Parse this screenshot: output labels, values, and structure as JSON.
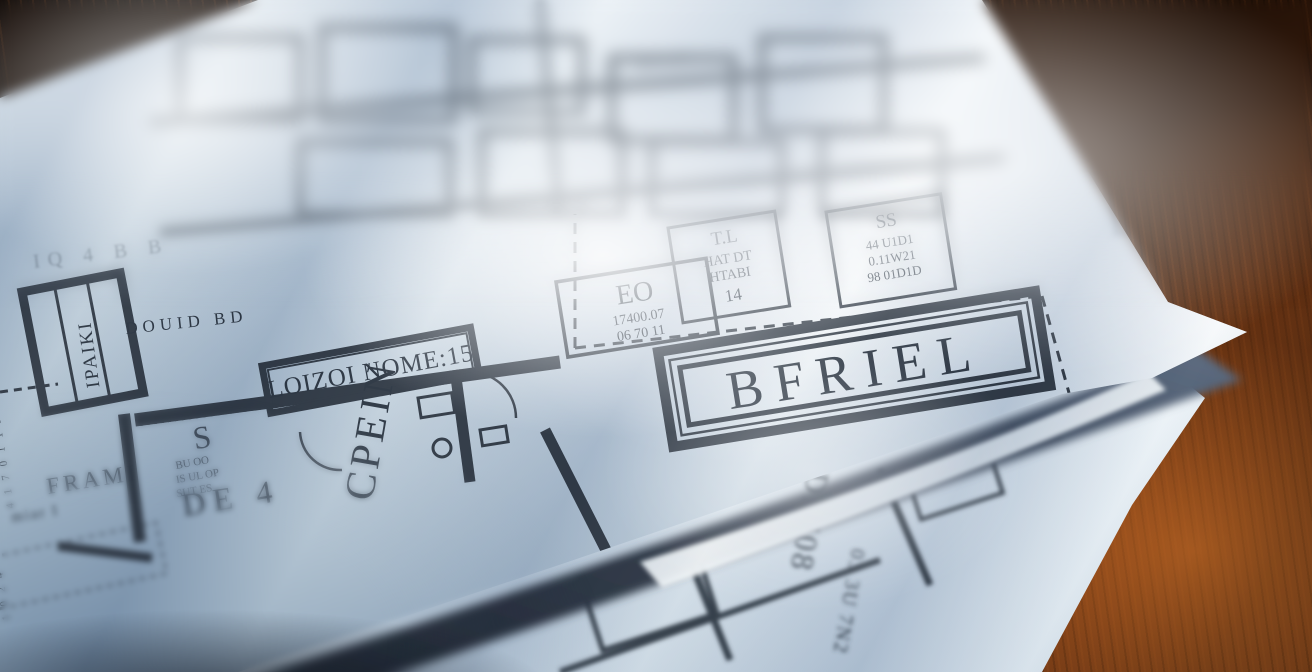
{
  "scene": {
    "subject": "Two architectural floor plan blueprint sheets lying on a dark oak table in diagonal window light",
    "colors": {
      "paper_highlight": "#f8fbfd",
      "paper_shadow": "#93a9bd",
      "ink": "#39424d",
      "wood_dark": "#170b04",
      "wood_grain": "#c46824",
      "under_shadow": "#2f3845"
    }
  },
  "top_sheet": {
    "banner": "LOIZOI NOME:15",
    "room_vertical": "CPEIN",
    "closet_vertical": "IPAIKI",
    "title_block": "BFRIEL",
    "boxes": {
      "eo": {
        "title": "EO",
        "line1": "17400.07",
        "line2": "06 70 11"
      },
      "tl": {
        "title": "T.L",
        "line1": "HAT DT",
        "line2": "HTABI",
        "line3": "14"
      },
      "ss": {
        "title": "SS",
        "line1": "44 U1D1",
        "line2": "0.11W21",
        "line3": "98 01D1D"
      }
    },
    "notes": {
      "double": "DOUID BD",
      "frame": "FRAMI",
      "frame_sub": "miar I",
      "de": "DE 4",
      "spec_s": "S",
      "spec1": "BU OO",
      "spec2": "IS UL OP",
      "spec3": "SUT ES",
      "sta": "STA",
      "blur_label": "HA DT",
      "top_dims": "IQ 4 B B",
      "left_dims": "4 1 7 0 1 1 3",
      "left_dims2": "1 0 2 4",
      "corner": "LT"
    }
  },
  "bottom_sheet": {
    "v1": "DRI08",
    "v2": "03 3U 7N2"
  }
}
